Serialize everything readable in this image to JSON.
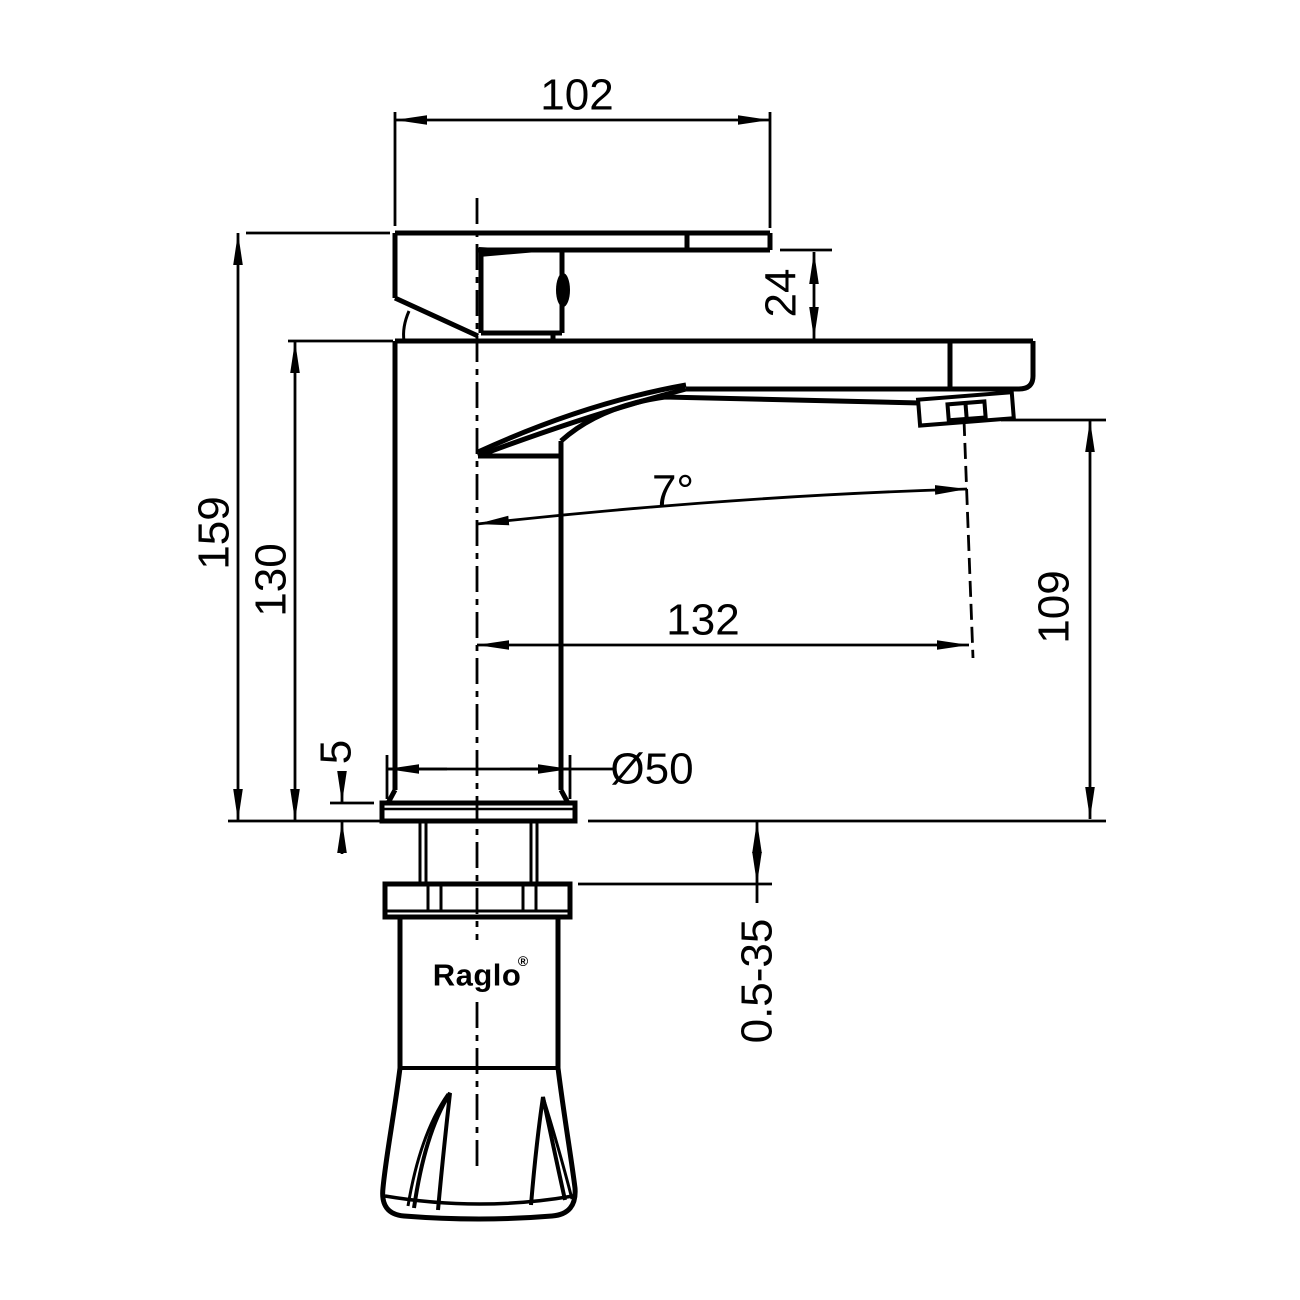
{
  "drawing": {
    "background": "#ffffff",
    "line_color": "#000000",
    "brand": "Raglo",
    "registered_mark": "®",
    "dimensions": {
      "handle_width": "102",
      "handle_height": "24",
      "overall_height": "159",
      "body_height": "130",
      "outlet_height": "109",
      "spout_reach": "132",
      "outlet_angle": "7°",
      "base_diameter": "Ø50",
      "flange_thickness": "5",
      "mount_thickness_range": "0.5-35"
    }
  }
}
